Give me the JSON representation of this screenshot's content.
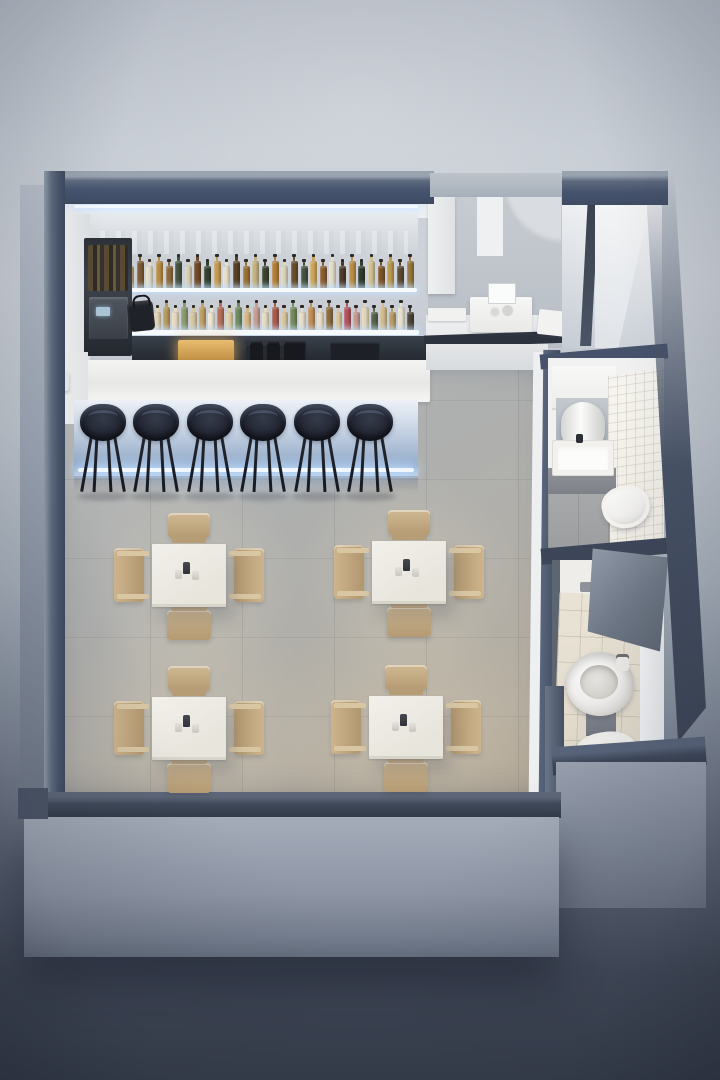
{
  "scene": {
    "kind": "axonometric-cutaway-3d-render",
    "subject": "Small cafe bar interior seen from above: back bar with two illuminated liquor shelves, espresso station, white bar counter with beer taps, six dark bar stools, four white dining tables with light-wood chairs, service counter with register, rear corridor and two restrooms along the right side"
  },
  "palette": {
    "backdrop_light": "#c9ced5",
    "ground_dark": "#343b49",
    "wall_cap": "#46536a",
    "exterior_wall": "#98a1b0",
    "interior_white": "#f1f1f1",
    "floor_gray": "#afb0af",
    "floor_warm": "#b3a896",
    "led_glow": "#e8f2ff",
    "bar_front_glow": "#a9bcd5",
    "stool_dark": "#222633",
    "wood_light": "#cdb48c",
    "tile_beige": "#e5dfd0",
    "counter_dark": "#2c333f",
    "display_case_warm": "#d9a858"
  },
  "bar": {
    "shelf_count": 2,
    "bottle_row_upper": [
      "#c9a469",
      "#7e5a33",
      "#e3dcc6",
      "#b78c44",
      "#8a6a3a",
      "#45523e",
      "#d9d0b4",
      "#6e4a28",
      "#32402f",
      "#c59a52",
      "#e6e0cc",
      "#573f26",
      "#9a7034",
      "#c3b384",
      "#39442f",
      "#b27e38",
      "#ddd4ba",
      "#6a4e2a",
      "#475240",
      "#cda65c",
      "#8a5c30",
      "#e4ddc8",
      "#4e3b27",
      "#bb8f46",
      "#303a2d",
      "#d0c295",
      "#7d5429",
      "#bd9a50",
      "#5d4930",
      "#97783c"
    ],
    "bottle_row_lower": [
      "#e6dec6",
      "#d7b88a",
      "#c6908a",
      "#e2d5b2",
      "#b89a5e",
      "#e9dabd",
      "#8c9c6e",
      "#d6c7a0",
      "#c19f60",
      "#eee5d1",
      "#b76e58",
      "#dfcfa6",
      "#6e8a5e",
      "#d4b686",
      "#c79d93",
      "#e5dcc0",
      "#a45c4c",
      "#d8c69a",
      "#74895c",
      "#e7dfca",
      "#c08e56",
      "#ebdec4",
      "#8a6c3e",
      "#dbc89e",
      "#b0525c",
      "#c8988c",
      "#e3d7ba",
      "#556349",
      "#d1ba8e",
      "#ba9a62",
      "#e8e1ce",
      "#4a4436"
    ],
    "stool_count": 6,
    "stool_lefts": [
      80,
      133,
      187,
      240,
      294,
      347
    ],
    "tap_count": 3,
    "equipment": [
      "coffee-machine",
      "bottle-rack",
      "heated-display-case",
      "under-counter-appliances",
      "barista-bag"
    ]
  },
  "dining": {
    "table_count": 4,
    "chairs_per_table": 4,
    "tables": [
      {
        "x": 152,
        "y": 544
      },
      {
        "x": 372,
        "y": 541
      },
      {
        "x": 152,
        "y": 697
      },
      {
        "x": 369,
        "y": 696
      }
    ],
    "tabletop_items": [
      "pepper-grinder",
      "salt-shaker",
      "salt-shaker"
    ]
  },
  "service_area": {
    "equipment": [
      "cash-register",
      "tray",
      "counter-box"
    ],
    "features": [
      "upper-cabinet",
      "curved-wall",
      "dark-counter-edge"
    ]
  },
  "restrooms": [
    {
      "name": "restroom-1",
      "fixtures": [
        "vanity",
        "mirror",
        "hand-dryer",
        "rectangular-sink",
        "wall-tiles",
        "toilet"
      ]
    },
    {
      "name": "restroom-2",
      "fixtures": [
        "round-washbasin",
        "soap-dispenser",
        "pedestal",
        "toilet",
        "beige-floor-tiles",
        "open-door"
      ]
    }
  ],
  "corridor": {
    "features": [
      "dark-door",
      "angled-white-wall",
      "ceiling-glow"
    ]
  }
}
